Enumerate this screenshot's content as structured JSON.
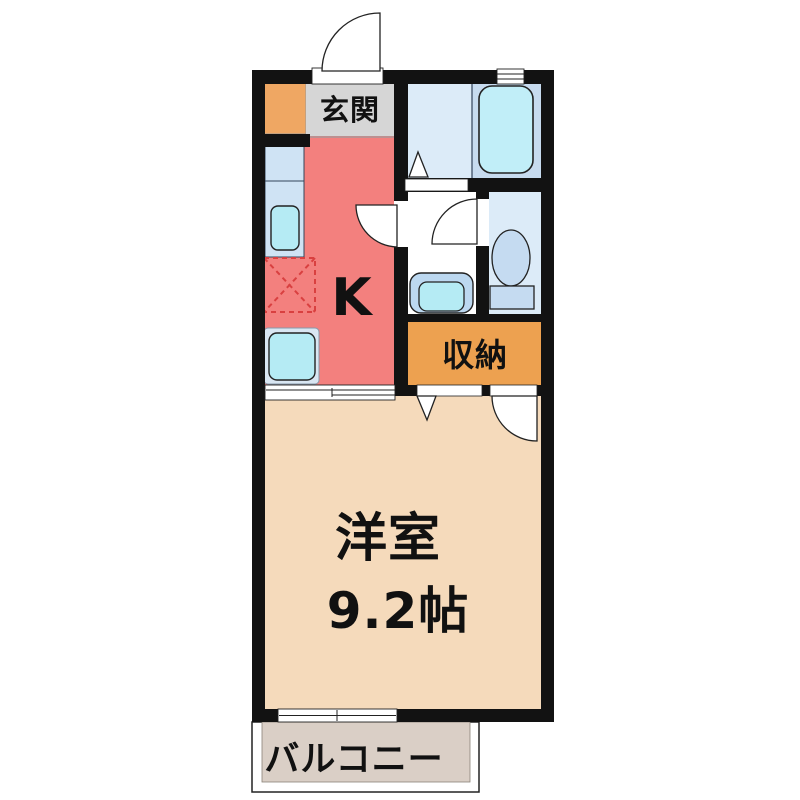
{
  "plan": {
    "title": "1K apartment floor plan",
    "rooms": {
      "genkan": {
        "label": "玄関"
      },
      "kitchen": {
        "label": "K"
      },
      "storage": {
        "label": "収納"
      },
      "western_room": {
        "label": "洋室",
        "size": "9.2帖"
      },
      "balcony": {
        "label": "バルコニー"
      }
    },
    "colors": {
      "wall": "#121212",
      "kitchen": "#F3807E",
      "genkan_floor": "#D6D6D6",
      "shoe_cabinet": "#EFA763",
      "storage": "#EDA150",
      "western_room": "#F5DABB",
      "balcony_floor": "#DACFC6",
      "bath_floor": "#DCEBF8",
      "bath_tub_area": "#C7DBEF",
      "bathtub": "#C1EEF8",
      "toilet_room": "#DCEBF8",
      "fixture_blue": "#C5DBF1",
      "counter": "#CFE3F4",
      "sink_cyan": "#B5EBF4",
      "basin_outer": "#BCD8F0",
      "appliance_outer": "#D9E6F2",
      "refrigerator_dashed": "#D94040"
    }
  }
}
